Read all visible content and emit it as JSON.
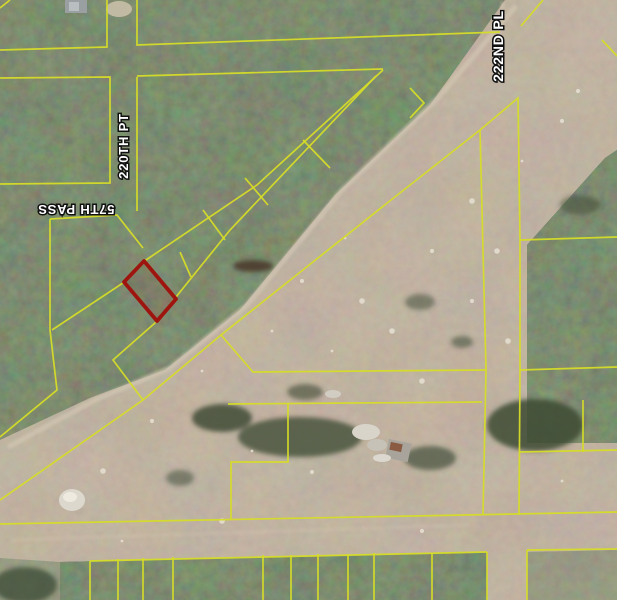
{
  "map": {
    "type": "aerial-parcel-map",
    "street_labels": [
      {
        "text": "220TH PT",
        "x": 128,
        "y": 146,
        "rotation": -90,
        "font_size": 13
      },
      {
        "text": "57TH PASS",
        "x": 76,
        "y": 205,
        "rotation": 180,
        "font_size": 13
      },
      {
        "text": "222ND PL",
        "x": 503,
        "y": 46,
        "rotation": -90,
        "font_size": 14
      }
    ],
    "highlighted_parcel": {
      "points": "144,261 176,299 157,321 124,282",
      "stroke": "#9e150f",
      "fill": "rgba(158,21,15,0.10)",
      "stroke_width": 3.8
    },
    "colors": {
      "parcel_line": "#d6dc28",
      "highlight": "#9e150f",
      "forest": "#44513a",
      "dirt": "#9a8a77",
      "sand_road": "#d4c8b3",
      "label_fill": "#ffffff",
      "label_halo": "#111111"
    },
    "parcel_lines": [
      "M107,0 L107,47 L0,50",
      "M0,8 L10,0",
      "M137,0 L137,45 L500,32",
      "M543,0 L521,26",
      "M0,78 L110,77 L110,183 L0,184",
      "M137,77 L137,211",
      "M137,76 L383,69",
      "M50,219 L117,215 L143,248",
      "M50,219 L50,330 L57,390 L0,437",
      "M383,70 L257,185 L143,262 L123,283 L52,330",
      "M155,323 L113,360 L143,400",
      "M376,76 L230,230 L155,323",
      "M180,252 L191,277",
      "M203,210 L225,240",
      "M245,178 L268,205",
      "M303,140 L330,168",
      "M480,130 L391,200 L221,335 L143,400 L0,500",
      "M480,130 L518,98 L520,240 L520,370",
      "M520,240 L617,237",
      "M480,130 L486,370",
      "M221,335 L253,372 L486,370",
      "M520,370 L617,367",
      "M486,370 L483,515",
      "M520,370 L519,515",
      "M519,452 L617,450",
      "M583,400 L583,452",
      "M228,404 L482,402",
      "M288,404 L288,462 L231,462 L231,519",
      "M0,524 L617,512",
      "M90,561 L487,552",
      "M90,561 L90,600",
      "M118,559 L118,600",
      "M143,558 L143,600",
      "M173,557 L173,600",
      "M263,555 L263,600",
      "M291,555 L291,600",
      "M318,554 L318,600",
      "M348,554 L348,600",
      "M374,553 L374,600",
      "M432,553 L432,600",
      "M487,552 L487,600",
      "M527,550 L617,549",
      "M527,550 L527,600",
      "M602,40 L617,56",
      "M410,88 L424,103 L410,118"
    ],
    "dirt_specks": [
      [
        345,
        238
      ],
      [
        302,
        281
      ],
      [
        362,
        301
      ],
      [
        272,
        331
      ],
      [
        432,
        251
      ],
      [
        472,
        201
      ],
      [
        522,
        161
      ],
      [
        562,
        121
      ],
      [
        392,
        331
      ],
      [
        202,
        371
      ],
      [
        152,
        421
      ],
      [
        103,
        471
      ],
      [
        252,
        451
      ],
      [
        312,
        472
      ],
      [
        422,
        381
      ],
      [
        332,
        351
      ],
      [
        472,
        301
      ],
      [
        508,
        341
      ],
      [
        562,
        481
      ],
      [
        422,
        531
      ],
      [
        222,
        521
      ],
      [
        122,
        541
      ],
      [
        578,
        91
      ],
      [
        497,
        251
      ]
    ]
  }
}
